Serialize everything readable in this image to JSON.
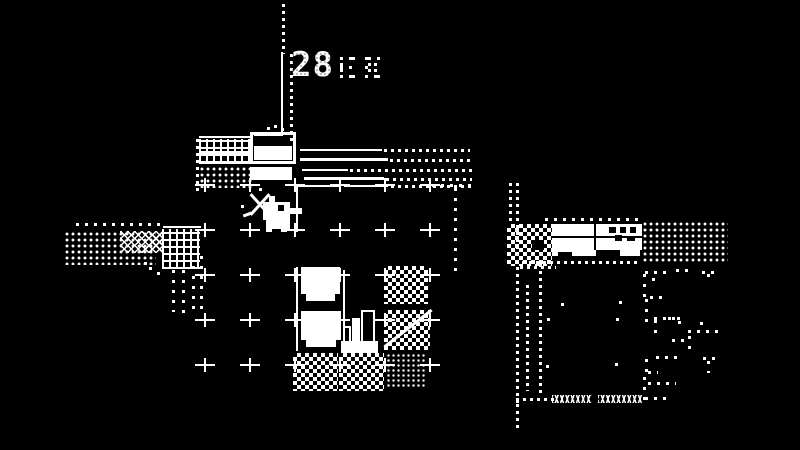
{
  "meta": {
    "app": "1-bit adventure game screen (Minit style)",
    "bg": "#000000",
    "fg": "#ffffff"
  },
  "hud": {
    "timer": "28",
    "timer_decor": "dithered small glyphs"
  },
  "player": {
    "name": "duck hero",
    "facing": "right",
    "x": 257,
    "y": 196,
    "cell": 3,
    "sprite": [
      "....##..........",
      "....##..........",
      "..#########.....",
      "..#####BB##.....",
      "..#####BB######.",
      "..#############.",
      "..#########.....",
      "..#########.....",
      "...########.....",
      "...########.....",
      "...########.....",
      "...##...##......"
    ]
  },
  "hud_glyphs": {
    "x": 340,
    "y": 57,
    "cell": 3,
    "g1": [
      "#..##.",
      "......",
      "#.....",
      "#..#..",
      "#.....",
      "......",
      "#..##."
    ],
    "g2": [
      ".##..#",
      "......",
      "..#.#.",
      ".#....",
      "..#.#.",
      "......",
      ".#..##"
    ]
  },
  "scene": {
    "grid": {
      "xs": [
        205,
        250,
        295,
        340,
        385,
        430
      ],
      "ys": [
        185,
        230,
        275,
        320,
        365
      ]
    },
    "elements": [
      {
        "type": "dotv",
        "name": "divider-dotted-top",
        "x": 282,
        "y": 4,
        "h": 50
      },
      {
        "type": "vline",
        "name": "divider-line",
        "x": 281,
        "y": 52,
        "h": 84
      },
      {
        "type": "dotv",
        "name": "divider-dotted-right",
        "x": 290,
        "y": 54,
        "h": 88
      },
      {
        "type": "hline",
        "name": "divider-corner",
        "x": 254,
        "y": 133,
        "w": 29,
        "h": 3
      },
      {
        "type": "hline",
        "name": "desk-roof-edge",
        "x": 199,
        "y": 136,
        "w": 54
      },
      {
        "type": "waffle",
        "name": "desk-texture",
        "x": 199,
        "y": 139,
        "w": 53,
        "h": 24
      },
      {
        "type": "white",
        "name": "desk-band",
        "x": 199,
        "y": 151,
        "w": 53,
        "h": 5
      },
      {
        "type": "hline",
        "name": "desk-bottom-edge",
        "x": 199,
        "y": 162,
        "w": 53
      },
      {
        "type": "stipple",
        "name": "desk-floor-dither",
        "x": 199,
        "y": 166,
        "w": 53,
        "h": 22
      },
      {
        "type": "dotv",
        "name": "desk-left-dotted-edge",
        "x": 196,
        "y": 139,
        "h": 52
      },
      {
        "type": "outline",
        "name": "bed-frame",
        "x": 250,
        "y": 132,
        "w": 46,
        "h": 32
      },
      {
        "type": "white",
        "name": "bed-sheet",
        "x": 254,
        "y": 146,
        "w": 38,
        "h": 14
      },
      {
        "type": "white",
        "name": "bench",
        "x": 250,
        "y": 167,
        "w": 42,
        "h": 13
      },
      {
        "type": "dot",
        "name": "chimney-dot",
        "x": 267,
        "y": 127
      },
      {
        "type": "dot",
        "name": "chimney-dot",
        "x": 274,
        "y": 125
      },
      {
        "type": "dot",
        "name": "chimney-dot",
        "x": 281,
        "y": 128
      },
      {
        "type": "hline",
        "name": "fence-rail",
        "x": 300,
        "y": 149,
        "w": 82
      },
      {
        "type": "doth",
        "name": "fence-rail-dotted",
        "x": 384,
        "y": 149,
        "w": 86
      },
      {
        "type": "hline",
        "name": "fence-rail",
        "x": 300,
        "y": 158,
        "w": 88,
        "h": 3
      },
      {
        "type": "doth",
        "name": "fence-rail-dotted",
        "x": 390,
        "y": 159,
        "w": 82
      },
      {
        "type": "hline",
        "name": "fence-rail",
        "x": 302,
        "y": 169,
        "w": 46
      },
      {
        "type": "doth",
        "name": "fence-rail-dotted",
        "x": 350,
        "y": 169,
        "w": 122
      },
      {
        "type": "hline",
        "name": "fence-rail",
        "x": 304,
        "y": 177,
        "w": 80,
        "h": 3
      },
      {
        "type": "doth",
        "name": "fence-rail-dotted",
        "x": 386,
        "y": 178,
        "w": 86
      },
      {
        "type": "hline",
        "name": "floor-top-edge",
        "x": 297,
        "y": 185,
        "w": 44
      },
      {
        "type": "hline",
        "name": "floor-top-edge",
        "x": 344,
        "y": 185,
        "w": 44
      },
      {
        "type": "doth",
        "name": "floor-top-edge-dotted",
        "x": 391,
        "y": 185,
        "w": 80
      },
      {
        "type": "doth-s",
        "name": "floor-top-edge-dotted",
        "x": 432,
        "y": 184,
        "w": 40
      },
      {
        "type": "dotv-s",
        "name": "floor-right-dotted-edge",
        "x": 454,
        "y": 188,
        "h": 86
      },
      {
        "type": "doth-s",
        "name": "path-dots-top",
        "x": 76,
        "y": 223,
        "w": 88
      },
      {
        "type": "stipple",
        "name": "path-dither",
        "x": 64,
        "y": 231,
        "w": 92,
        "h": 34
      },
      {
        "type": "crosshatch",
        "name": "path-crosshatch",
        "x": 120,
        "y": 231,
        "w": 42,
        "h": 22
      },
      {
        "type": "hline",
        "name": "path-edge",
        "x": 163,
        "y": 226,
        "w": 38
      },
      {
        "type": "waffle",
        "name": "path-waffle",
        "x": 162,
        "y": 229,
        "w": 38,
        "h": 40
      },
      {
        "type": "dotv-s",
        "name": "path-trail-dots",
        "x": 172,
        "y": 270,
        "h": 42
      },
      {
        "type": "dotv-s",
        "name": "path-trail-dots",
        "x": 182,
        "y": 270,
        "h": 46
      },
      {
        "type": "dotv-s",
        "name": "path-trail-dots",
        "x": 192,
        "y": 266,
        "h": 46
      },
      {
        "type": "dotv-s",
        "name": "path-trail-dots",
        "x": 200,
        "y": 256,
        "h": 56
      },
      {
        "type": "dot",
        "name": "stray-dot",
        "x": 149,
        "y": 267
      },
      {
        "type": "dot",
        "name": "stray-dot",
        "x": 157,
        "y": 272
      },
      {
        "type": "dot",
        "name": "stray-dot",
        "x": 144,
        "y": 262
      },
      {
        "type": "vline",
        "name": "tile-edge",
        "x": 296,
        "y": 186,
        "h": 46
      },
      {
        "type": "vline",
        "name": "tile-edge",
        "x": 296,
        "y": 267,
        "h": 84
      },
      {
        "type": "vline",
        "name": "tile-edge",
        "x": 343,
        "y": 270,
        "h": 80
      },
      {
        "type": "white",
        "name": "table-block",
        "x": 301,
        "y": 267,
        "w": 39,
        "h": 34
      },
      {
        "type": "black",
        "name": "table-leg-notch",
        "x": 301,
        "y": 294,
        "w": 5,
        "h": 7
      },
      {
        "type": "black",
        "name": "table-leg-notch",
        "x": 335,
        "y": 294,
        "w": 5,
        "h": 7
      },
      {
        "type": "white",
        "name": "table-block",
        "x": 301,
        "y": 311,
        "w": 40,
        "h": 36
      },
      {
        "type": "black",
        "name": "table-leg-notch",
        "x": 301,
        "y": 340,
        "w": 5,
        "h": 7
      },
      {
        "type": "black",
        "name": "table-leg-notch",
        "x": 336,
        "y": 340,
        "w": 5,
        "h": 7
      },
      {
        "type": "white",
        "name": "stairs-base",
        "x": 341,
        "y": 341,
        "w": 37,
        "h": 12
      },
      {
        "type": "outline2",
        "name": "stairs-bar-tall",
        "x": 361,
        "y": 310,
        "w": 14,
        "h": 33
      },
      {
        "type": "white",
        "name": "stairs-bar-mid",
        "x": 352,
        "y": 318,
        "w": 8,
        "h": 24
      },
      {
        "type": "outline2",
        "name": "stairs-bar-small",
        "x": 343,
        "y": 326,
        "w": 8,
        "h": 17
      },
      {
        "type": "checker",
        "name": "checker-tile",
        "x": 384,
        "y": 266,
        "w": 44,
        "h": 38
      },
      {
        "type": "checker",
        "name": "checker-tile",
        "x": 384,
        "y": 310,
        "w": 46,
        "h": 40
      },
      {
        "type": "diag",
        "name": "checker-tile-slash",
        "x": 378,
        "y": 327,
        "w": 60,
        "rot": -38
      },
      {
        "type": "checker",
        "name": "checker-tile",
        "x": 293,
        "y": 353,
        "w": 45,
        "h": 38
      },
      {
        "type": "checker",
        "name": "checker-tile",
        "x": 339,
        "y": 353,
        "w": 45,
        "h": 38
      },
      {
        "type": "stipple5",
        "name": "striped-tile",
        "x": 386,
        "y": 353,
        "w": 40,
        "h": 36
      },
      {
        "type": "dotv",
        "name": "cliff-dotted-edge",
        "x": 509,
        "y": 183,
        "h": 42
      },
      {
        "type": "dotv",
        "name": "cliff-dotted-edge-long",
        "x": 516,
        "y": 183,
        "h": 220
      },
      {
        "type": "checker",
        "name": "cliff-dither",
        "x": 507,
        "y": 224,
        "w": 45,
        "h": 42
      },
      {
        "type": "black",
        "name": "cliff-notch",
        "x": 532,
        "y": 240,
        "w": 12,
        "h": 10
      },
      {
        "type": "doth-s",
        "name": "roof-top-dots",
        "x": 545,
        "y": 218,
        "w": 94
      },
      {
        "type": "white",
        "name": "house-roof",
        "x": 552,
        "y": 224,
        "w": 90,
        "h": 26
      },
      {
        "type": "black",
        "name": "house-roof-seam",
        "x": 552,
        "y": 236,
        "w": 90,
        "h": 2
      },
      {
        "type": "black",
        "name": "house-roof-divider",
        "x": 594,
        "y": 224,
        "w": 2,
        "h": 26
      },
      {
        "type": "black",
        "name": "house-window",
        "x": 609,
        "y": 227,
        "w": 7,
        "h": 6
      },
      {
        "type": "black",
        "name": "house-window",
        "x": 620,
        "y": 227,
        "w": 6,
        "h": 6
      },
      {
        "type": "black",
        "name": "house-window",
        "x": 630,
        "y": 227,
        "w": 6,
        "h": 6
      },
      {
        "type": "black",
        "name": "house-window",
        "x": 615,
        "y": 235,
        "w": 7,
        "h": 6
      },
      {
        "type": "black",
        "name": "house-window",
        "x": 627,
        "y": 236,
        "w": 8,
        "h": 5
      },
      {
        "type": "white",
        "name": "house-step-strip",
        "x": 552,
        "y": 250,
        "w": 88,
        "h": 6
      },
      {
        "type": "black",
        "name": "house-step-notch",
        "x": 558,
        "y": 252,
        "w": 14,
        "h": 4
      },
      {
        "type": "black",
        "name": "house-step-notch",
        "x": 596,
        "y": 250,
        "w": 24,
        "h": 6
      },
      {
        "type": "doth",
        "name": "house-ground-dots",
        "x": 508,
        "y": 261,
        "w": 132
      },
      {
        "type": "doth",
        "name": "house-ground-dots",
        "x": 520,
        "y": 266,
        "w": 36
      },
      {
        "type": "stipple",
        "name": "gravel-field",
        "x": 642,
        "y": 221,
        "w": 86,
        "h": 42
      },
      {
        "type": "dotv",
        "name": "yard-dotted-line",
        "x": 526,
        "y": 285,
        "h": 106
      },
      {
        "type": "dotv",
        "name": "yard-dotted-line",
        "x": 539,
        "y": 264,
        "h": 130
      },
      {
        "type": "doth",
        "name": "yard-bottom-dots",
        "x": 516,
        "y": 398,
        "w": 38
      },
      {
        "type": "dotv",
        "name": "yard-bottom-dots",
        "x": 516,
        "y": 404,
        "h": 26
      },
      {
        "type": "zigzag",
        "name": "water-waves",
        "x": 552,
        "y": 395,
        "w": 40
      },
      {
        "type": "zigzag",
        "name": "water-waves",
        "x": 598,
        "y": 395,
        "w": 44
      },
      {
        "type": "doth-s",
        "name": "rock-outline",
        "x": 645,
        "y": 271,
        "w": 26
      },
      {
        "type": "doth-s",
        "name": "rock-outline",
        "x": 676,
        "y": 269,
        "w": 18
      },
      {
        "type": "doth-s",
        "name": "rock-outline",
        "x": 702,
        "y": 271,
        "w": 12
      },
      {
        "type": "dotv-s",
        "name": "rock-outline",
        "x": 707,
        "y": 274,
        "h": 10
      },
      {
        "type": "dotv-s",
        "name": "rock-outline",
        "x": 643,
        "y": 274,
        "h": 26
      },
      {
        "type": "dotv-s",
        "name": "rock-outline",
        "x": 652,
        "y": 278,
        "h": 10
      },
      {
        "type": "dotv-s",
        "name": "rock-outline",
        "x": 645,
        "y": 299,
        "h": 30
      },
      {
        "type": "doth-s",
        "name": "rock-outline",
        "x": 650,
        "y": 296,
        "w": 12
      },
      {
        "type": "doth-s",
        "name": "rock-outline",
        "x": 654,
        "y": 317,
        "w": 22
      },
      {
        "type": "dotv-s",
        "name": "rock-outline",
        "x": 654,
        "y": 320,
        "h": 14
      },
      {
        "type": "doth-s",
        "name": "rock-outline",
        "x": 668,
        "y": 317,
        "w": 14
      },
      {
        "type": "dotv-s",
        "name": "rock-outline",
        "x": 678,
        "y": 321,
        "h": 10
      },
      {
        "type": "doth-s",
        "name": "rock-outline",
        "x": 688,
        "y": 330,
        "w": 30
      },
      {
        "type": "dotv-s",
        "name": "rock-outline",
        "x": 688,
        "y": 336,
        "h": 14
      },
      {
        "type": "doth-s",
        "name": "rock-outline",
        "x": 672,
        "y": 339,
        "w": 18
      },
      {
        "type": "dotv-s",
        "name": "rock-outline",
        "x": 700,
        "y": 322,
        "h": 8
      },
      {
        "type": "doth-s",
        "name": "rock-outline",
        "x": 656,
        "y": 356,
        "w": 22
      },
      {
        "type": "doth-s",
        "name": "rock-outline",
        "x": 703,
        "y": 357,
        "w": 14
      },
      {
        "type": "dotv-s",
        "name": "rock-outline",
        "x": 707,
        "y": 361,
        "h": 12
      },
      {
        "type": "dotv-s",
        "name": "rock-outline",
        "x": 645,
        "y": 359,
        "h": 18
      },
      {
        "type": "doth-s",
        "name": "rock-outline",
        "x": 648,
        "y": 371,
        "w": 10
      },
      {
        "type": "dotv-s",
        "name": "rock-outline",
        "x": 643,
        "y": 377,
        "h": 24
      },
      {
        "type": "doth-s",
        "name": "rock-outline",
        "x": 648,
        "y": 382,
        "w": 28
      },
      {
        "type": "doth-s",
        "name": "rock-outline",
        "x": 645,
        "y": 397,
        "w": 26
      },
      {
        "type": "dot",
        "name": "stray-dot",
        "x": 619,
        "y": 301
      },
      {
        "type": "dot",
        "name": "stray-dot",
        "x": 616,
        "y": 318
      },
      {
        "type": "dot",
        "name": "stray-dot",
        "x": 615,
        "y": 363
      },
      {
        "type": "dot",
        "name": "stray-dot",
        "x": 547,
        "y": 318
      },
      {
        "type": "dot",
        "name": "stray-dot",
        "x": 546,
        "y": 365
      },
      {
        "type": "dot",
        "name": "stray-dot",
        "x": 561,
        "y": 303
      },
      {
        "type": "diag",
        "name": "sword-slash",
        "x": 246,
        "y": 203,
        "w": 28,
        "rot": -48
      },
      {
        "type": "diag",
        "name": "sword-slash",
        "x": 246,
        "y": 203,
        "w": 28,
        "rot": 48
      },
      {
        "type": "diag",
        "name": "sword-spark",
        "x": 243,
        "y": 213,
        "w": 9,
        "rot": -20
      },
      {
        "type": "dot",
        "name": "sword-spark-dot",
        "x": 241,
        "y": 205
      },
      {
        "type": "dot",
        "name": "sword-spark-dot",
        "x": 259,
        "y": 188
      },
      {
        "type": "dot",
        "name": "sword-spark-dot",
        "x": 272,
        "y": 218
      }
    ]
  }
}
